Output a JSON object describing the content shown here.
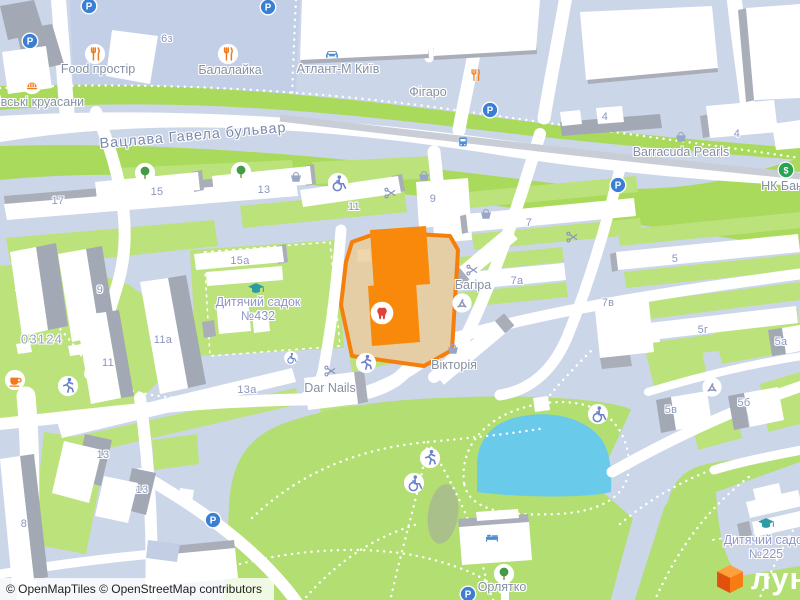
{
  "attribution": {
    "text": "© OpenMapTiles © OpenStreetMap contributors"
  },
  "logo": {
    "text": "лун"
  },
  "map": {
    "icon_glyphs": {
      "parking": "P",
      "money": "$"
    },
    "colors": {
      "background": "#ccd6e9",
      "block": "#c3cfe7",
      "road": "#ffffff",
      "park": "#b3de72",
      "boulevard_green": "#a9da5b",
      "court_green": "#bce27c",
      "water": "#69cbe9",
      "building": "#ffffff",
      "building_shadow": "#a9aeb9",
      "highlight_border": "#f57f0a",
      "highlight_building": "#f8890a",
      "highlight_plot": "#e5cda6",
      "parking_blue": "#3b7fd4",
      "poi_orange": "#ef7b1d",
      "tooth_red": "#e2403c",
      "school_teal": "#2d9aa5",
      "money_green": "#28a350",
      "logo_orange": "#f87c14"
    },
    "labels": [
      {
        "text": "Вацлава Гавела бульвар",
        "x": 193,
        "y": 136,
        "cls": "street",
        "rot": -5
      },
      {
        "text": "Food простір",
        "x": 98,
        "y": 69,
        "cls": "poi"
      },
      {
        "text": "Балалайка",
        "x": 230,
        "y": 70,
        "cls": "poi"
      },
      {
        "text": "Атлант-М Київ",
        "x": 338,
        "y": 69,
        "cls": "poi"
      },
      {
        "text": "Фігаро",
        "x": 428,
        "y": 92,
        "cls": "poi"
      },
      {
        "text": "Barracuda Pearls",
        "x": 681,
        "y": 152,
        "cls": "poi"
      },
      {
        "text": "НК Бан",
        "x": 782,
        "y": 186,
        "cls": "poi"
      },
      {
        "text": "Багіра",
        "x": 473,
        "y": 285,
        "cls": "poi"
      },
      {
        "text": "Вікторія",
        "x": 454,
        "y": 365,
        "cls": "poi"
      },
      {
        "text": "Dar Nails",
        "x": 330,
        "y": 388,
        "cls": "poi"
      },
      {
        "text": "Орлятко",
        "x": 502,
        "y": 587,
        "cls": "poi"
      },
      {
        "text": "івські круасани",
        "x": 41,
        "y": 102,
        "cls": "poi"
      },
      {
        "text": "Дитячий садок №432",
        "x": 258,
        "y": 309,
        "cls": "school",
        "w": 86
      },
      {
        "text": "Дитячий садок №225",
        "x": 766,
        "y": 547,
        "cls": "school",
        "w": 96
      },
      {
        "text": "03124",
        "x": 42,
        "y": 339,
        "cls": "district"
      },
      {
        "text": "6з",
        "x": 167,
        "y": 39,
        "cls": "num"
      },
      {
        "text": "4",
        "x": 605,
        "y": 117,
        "cls": "num"
      },
      {
        "text": "4",
        "x": 737,
        "y": 134,
        "cls": "num"
      },
      {
        "text": "17",
        "x": 58,
        "y": 201,
        "cls": "num"
      },
      {
        "text": "15",
        "x": 157,
        "y": 192,
        "cls": "num"
      },
      {
        "text": "13",
        "x": 264,
        "y": 190,
        "cls": "num"
      },
      {
        "text": "11",
        "x": 354,
        "y": 207,
        "cls": "num"
      },
      {
        "text": "9",
        "x": 433,
        "y": 199,
        "cls": "num"
      },
      {
        "text": "7",
        "x": 529,
        "y": 223,
        "cls": "num"
      },
      {
        "text": "5",
        "x": 675,
        "y": 259,
        "cls": "num"
      },
      {
        "text": "7а",
        "x": 517,
        "y": 281,
        "cls": "num"
      },
      {
        "text": "7в",
        "x": 608,
        "y": 303,
        "cls": "num"
      },
      {
        "text": "5г",
        "x": 703,
        "y": 330,
        "cls": "num"
      },
      {
        "text": "5а",
        "x": 781,
        "y": 342,
        "cls": "num"
      },
      {
        "text": "5в",
        "x": 671,
        "y": 410,
        "cls": "num"
      },
      {
        "text": "5б",
        "x": 744,
        "y": 403,
        "cls": "num"
      },
      {
        "text": "15а",
        "x": 240,
        "y": 261,
        "cls": "num"
      },
      {
        "text": "9",
        "x": 100,
        "y": 290,
        "cls": "num"
      },
      {
        "text": "11а",
        "x": 163,
        "y": 340,
        "cls": "num"
      },
      {
        "text": "11",
        "x": 108,
        "y": 363,
        "cls": "num"
      },
      {
        "text": "13а",
        "x": 247,
        "y": 390,
        "cls": "num"
      },
      {
        "text": "13",
        "x": 103,
        "y": 455,
        "cls": "num"
      },
      {
        "text": "13",
        "x": 142,
        "y": 490,
        "cls": "num"
      },
      {
        "text": "8",
        "x": 24,
        "y": 524,
        "cls": "num"
      }
    ],
    "icons": [
      {
        "type": "parking",
        "x": 89,
        "y": 6
      },
      {
        "type": "parking",
        "x": 30,
        "y": 41
      },
      {
        "type": "parking",
        "x": 268,
        "y": 7
      },
      {
        "type": "parking",
        "x": 490,
        "y": 110
      },
      {
        "type": "parking",
        "x": 618,
        "y": 185
      },
      {
        "type": "parking",
        "x": 213,
        "y": 520
      },
      {
        "type": "parking",
        "x": 468,
        "y": 594
      },
      {
        "type": "restaurant",
        "x": 95,
        "y": 54
      },
      {
        "type": "restaurant",
        "x": 228,
        "y": 54
      },
      {
        "type": "restaurant-plain",
        "x": 475,
        "y": 75
      },
      {
        "type": "car",
        "x": 332,
        "y": 53
      },
      {
        "type": "bus",
        "x": 463,
        "y": 142
      },
      {
        "type": "money",
        "x": 786,
        "y": 170
      },
      {
        "type": "basket",
        "x": 296,
        "y": 177
      },
      {
        "type": "basket",
        "x": 424,
        "y": 176
      },
      {
        "type": "basket",
        "x": 486,
        "y": 214
      },
      {
        "type": "basket",
        "x": 453,
        "y": 349
      },
      {
        "type": "basket",
        "x": 681,
        "y": 137
      },
      {
        "type": "scissors",
        "x": 390,
        "y": 193
      },
      {
        "type": "scissors",
        "x": 572,
        "y": 237
      },
      {
        "type": "scissors",
        "x": 472,
        "y": 270
      },
      {
        "type": "scissors",
        "x": 330,
        "y": 371
      },
      {
        "type": "wheelchair",
        "x": 338,
        "y": 183
      },
      {
        "type": "wheelchair",
        "x": 291,
        "y": 358,
        "s": 15
      },
      {
        "type": "wheelchair",
        "x": 414,
        "y": 483
      },
      {
        "type": "wheelchair",
        "x": 598,
        "y": 414
      },
      {
        "type": "pedestrian",
        "x": 366,
        "y": 363
      },
      {
        "type": "pedestrian",
        "x": 68,
        "y": 386
      },
      {
        "type": "pedestrian",
        "x": 430,
        "y": 458
      },
      {
        "type": "tree",
        "x": 145,
        "y": 173
      },
      {
        "type": "tree",
        "x": 241,
        "y": 172
      },
      {
        "type": "tree",
        "x": 504,
        "y": 574
      },
      {
        "type": "grad-cap",
        "x": 256,
        "y": 289
      },
      {
        "type": "grad-cap",
        "x": 766,
        "y": 524
      },
      {
        "type": "recycle",
        "x": 462,
        "y": 303
      },
      {
        "type": "recycle",
        "x": 712,
        "y": 387
      },
      {
        "type": "tooth",
        "x": 382,
        "y": 313
      },
      {
        "type": "coffee",
        "x": 15,
        "y": 380
      },
      {
        "type": "bakery",
        "x": 32,
        "y": 84
      },
      {
        "type": "bed",
        "x": 492,
        "y": 537
      }
    ]
  }
}
